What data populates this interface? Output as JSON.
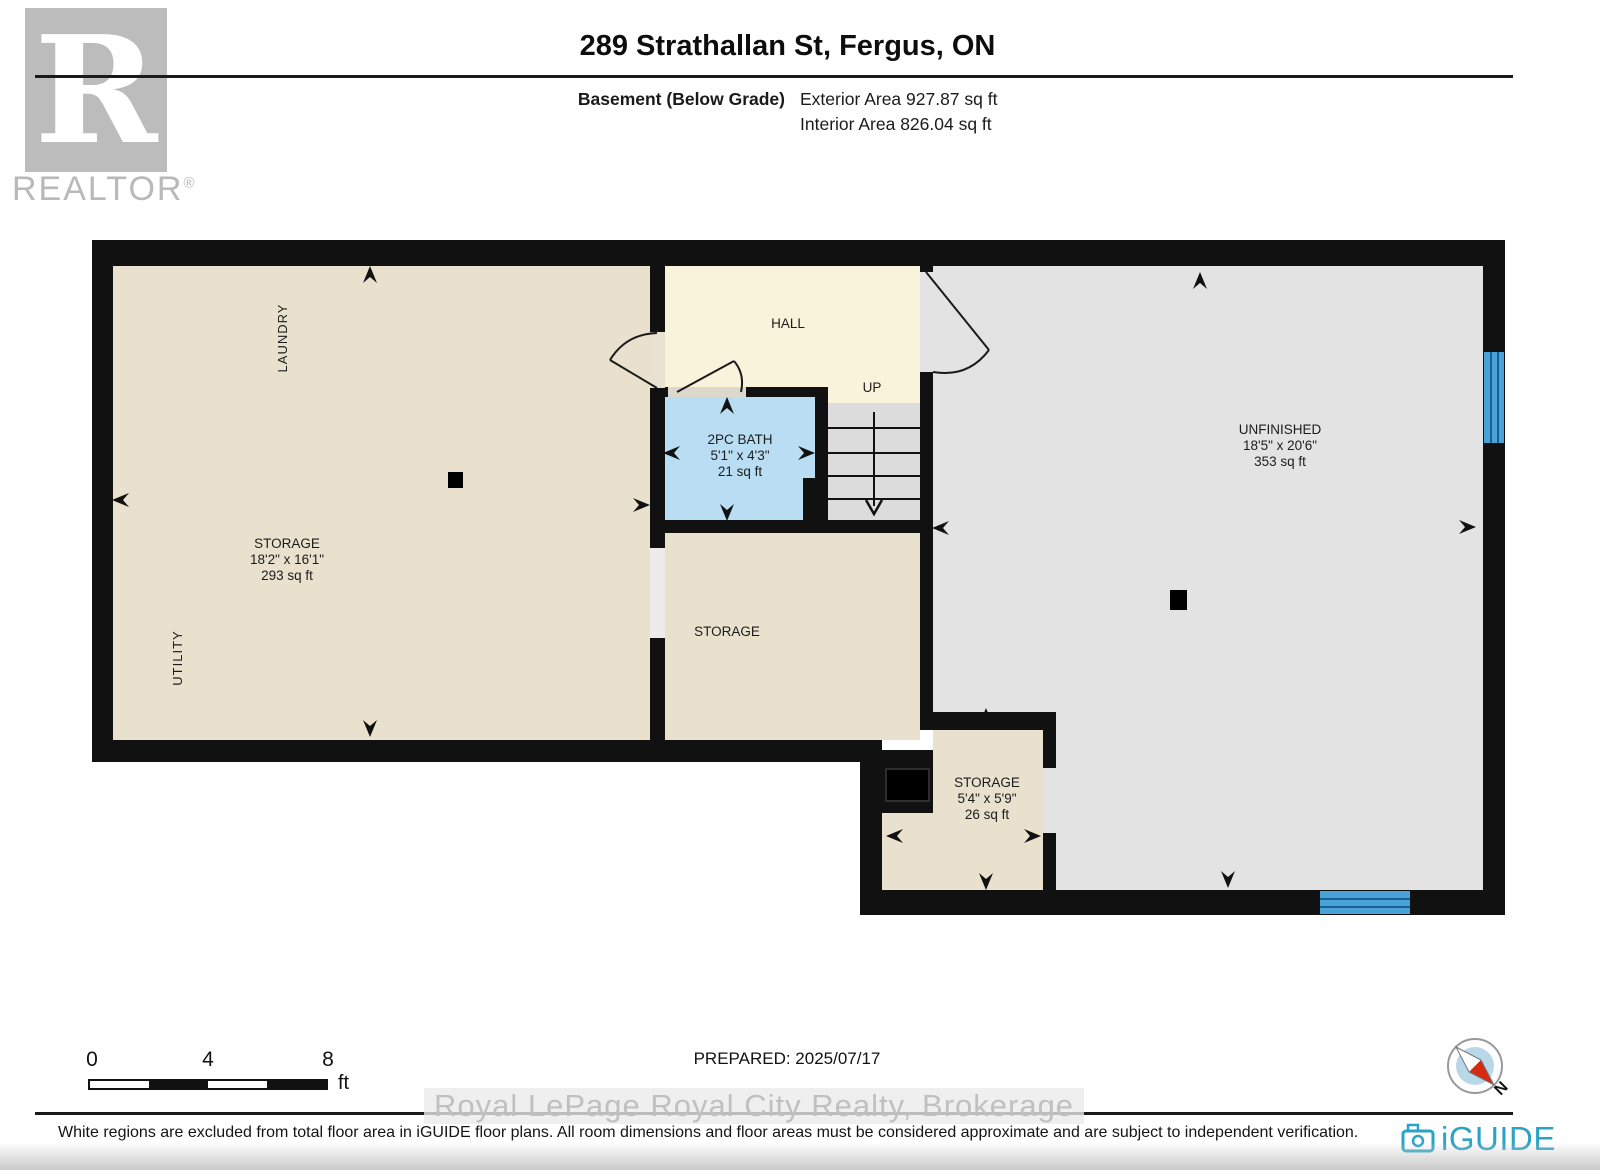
{
  "header": {
    "logo_letter": "R",
    "logo_brand": "REALTOR",
    "logo_reg": "®",
    "title": "289 Strathallan St, Fergus, ON",
    "floor_label": "Basement (Below Grade)",
    "exterior_area": "Exterior Area 927.87 sq ft",
    "interior_area": "Interior Area 826.04 sq ft"
  },
  "rooms": {
    "laundry": {
      "label": "LAUNDRY"
    },
    "storage_left": {
      "label": "STORAGE",
      "dims": "18'2\" x 16'1\"",
      "area": "293 sq ft"
    },
    "utility": {
      "label": "UTILITY"
    },
    "hall": {
      "label": "HALL"
    },
    "stairs": {
      "label": "UP"
    },
    "bath": {
      "label": "2PC BATH",
      "dims": "5'1\" x 4'3\"",
      "area": "21 sq ft"
    },
    "storage_mid": {
      "label": "STORAGE"
    },
    "unfinished": {
      "label": "UNFINISHED",
      "dims": "18'5\" x 20'6\"",
      "area": "353 sq ft"
    },
    "storage_small": {
      "label": "STORAGE",
      "dims": "5'4\" x 5'9\"",
      "area": "26 sq ft"
    }
  },
  "scale_bar": {
    "tick0": "0",
    "tick1": "4",
    "tick2": "8",
    "unit": "ft"
  },
  "footer": {
    "prepared": "PREPARED: 2025/07/17",
    "watermark": "Royal LePage Royal City Realty, Brokerage",
    "disclaimer": "White regions are excluded from total floor area in iGUIDE floor plans. All room dimensions and floor areas must be considered approximate and are subject to independent verification.",
    "brand": "iGUIDE",
    "compass_label": "N"
  },
  "colors": {
    "wall": "#111111",
    "room_beige": "#e9e1ce",
    "hall_cream": "#faf3dc",
    "bath_blue": "#b9ddf2",
    "unfinished_gray": "#e3e3e3",
    "stairs_gray": "#dcdcdc",
    "window_blue": "#4aa3d8",
    "brand_blue": "#2ba3c6",
    "compass_red": "#d42a10"
  }
}
